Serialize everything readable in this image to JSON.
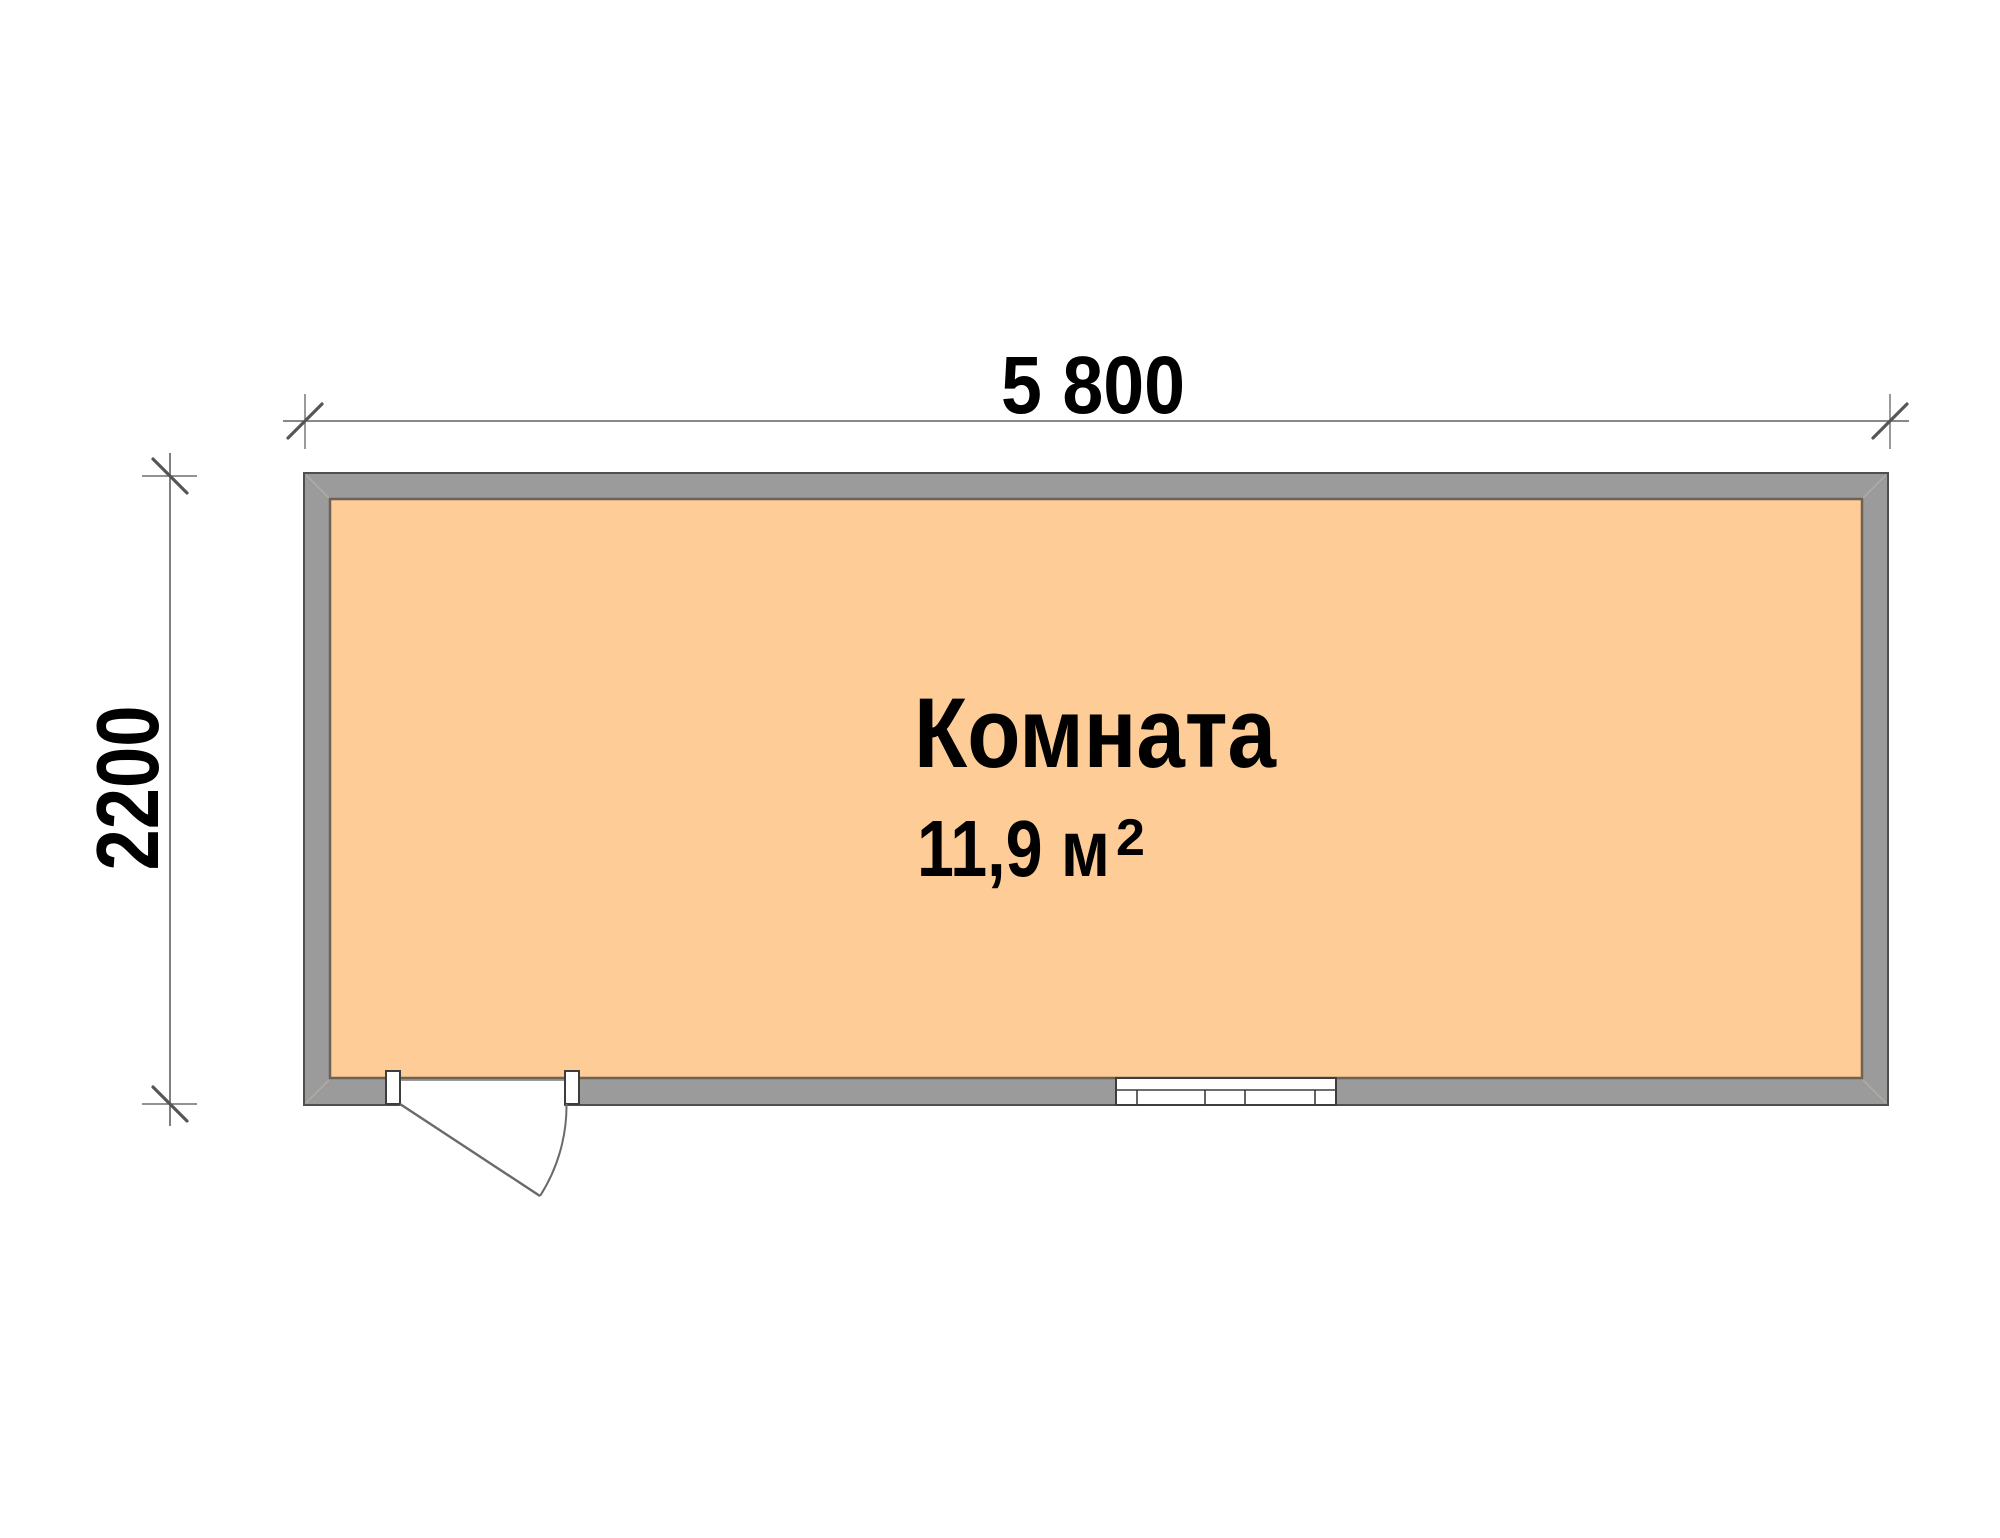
{
  "plan": {
    "type": "floor-plan",
    "room": {
      "name": "Комната",
      "area_value": "11,9 м",
      "area_sup": "2",
      "area_text": "11,9 м²"
    },
    "dimensions": {
      "width_label": "5 800",
      "height_label": "2200"
    },
    "features": {
      "door": "swing-door-icon",
      "window": "window-icon"
    },
    "colors": {
      "background": "#ffffff",
      "wall": "#9b9b9b",
      "wall_outline": "#4f4f4f",
      "floor": "#fdcc97",
      "floor_outline": "#6e6156",
      "dimension_line": "#606060",
      "text": "#000000"
    }
  }
}
